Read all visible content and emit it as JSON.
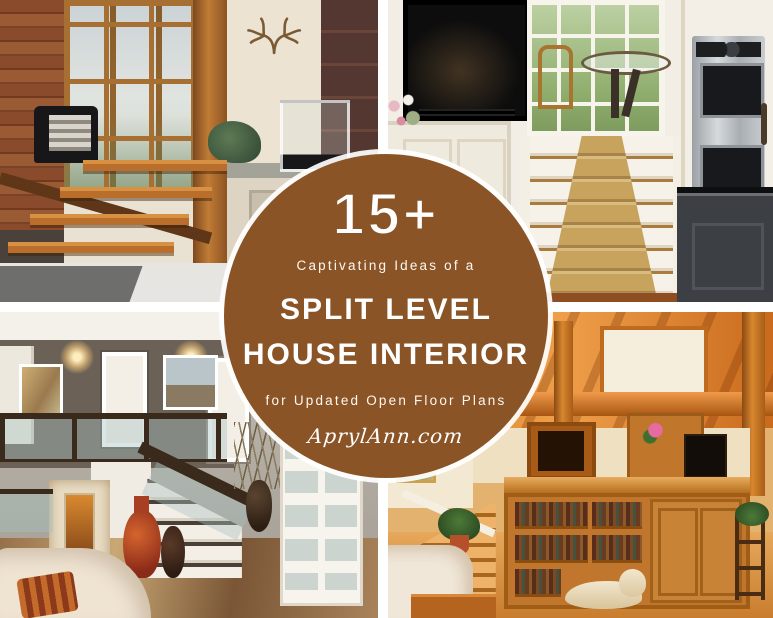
{
  "graphic": {
    "badge": {
      "count": "15+",
      "eyebrow": "Captivating Ideas of a",
      "title_line1": "SPLIT LEVEL",
      "title_line2": "HOUSE INTERIOR",
      "tagline": "for Updated Open Floor Plans",
      "website": "AprylAnn.com"
    },
    "colors": {
      "badge_brown": "#8B5426",
      "badge_text": "#FFFFFF",
      "ring_white": "rgba(255,255,255,0.92)",
      "gutter_white": "#FFFFFF"
    },
    "photos": [
      {
        "id": "top-left",
        "description": "Modern split-level entry with floating wood stair treads, wood plank wall, tall windows and antler wall decor"
      },
      {
        "id": "top-right",
        "description": "White kitchen with black fireplace, glass breakfast table by french windows, carpeted steps and stainless double wall ovens beside a dark island"
      },
      {
        "id": "bottom-left",
        "description": "Split-level foyer with dark wood and glass stair railing, lit wall sconces, tall decorative floor vases and white french doors"
      },
      {
        "id": "bottom-right",
        "description": "Warm timber-frame open plan interior with exposed beams, built-in bookshelves, steps and a dog resting on the wood floor"
      }
    ]
  }
}
